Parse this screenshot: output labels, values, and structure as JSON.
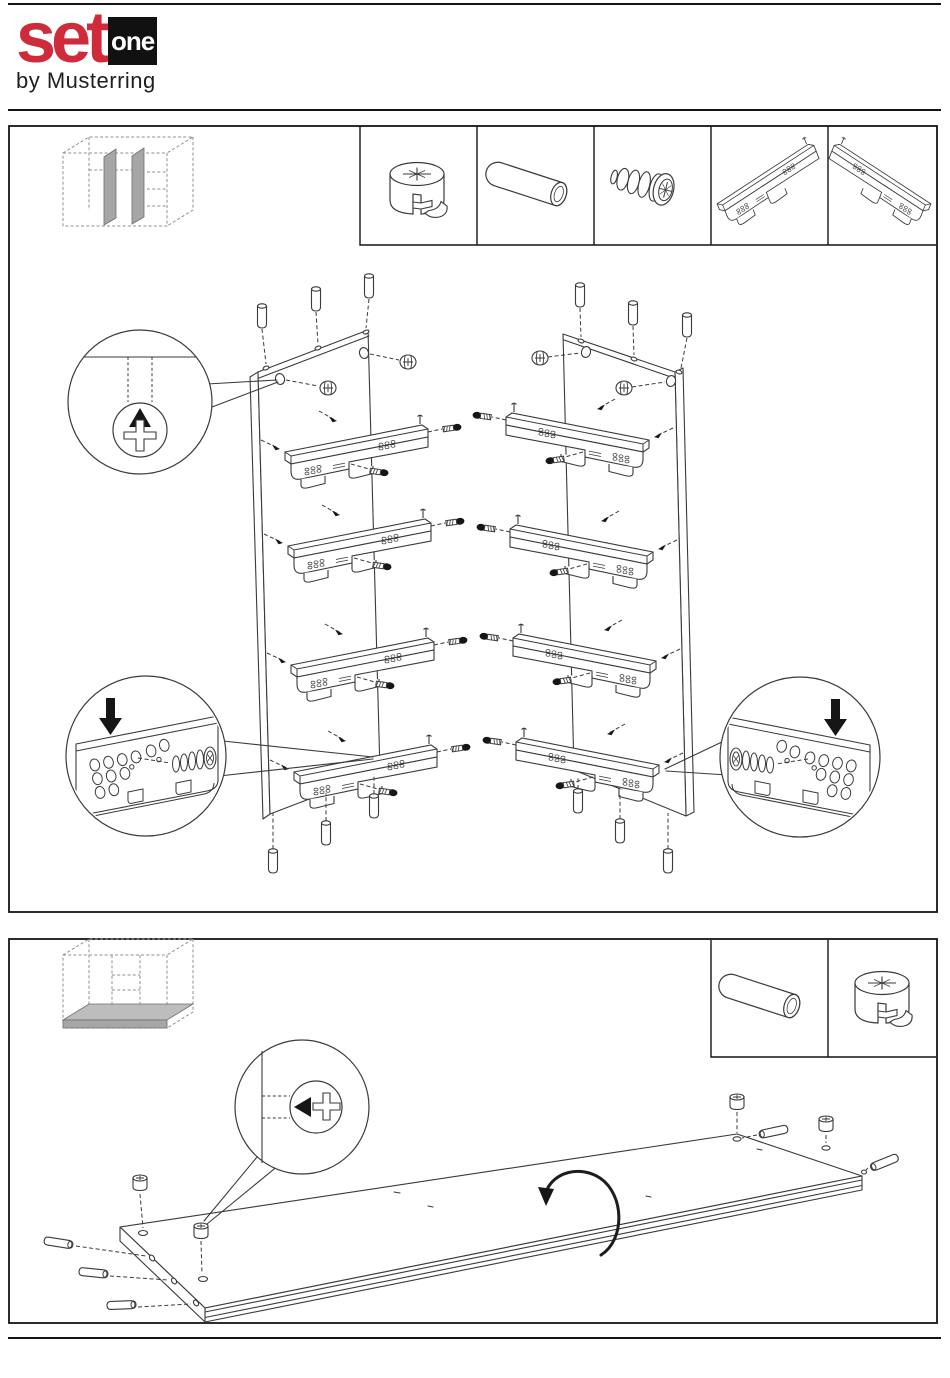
{
  "page": {
    "background": "#ffffff",
    "rule_color": "#141414"
  },
  "header": {
    "logo_word": "set",
    "logo_badge": "one",
    "logo_byline": "by Musterring",
    "brand_red": "#cf2b3b",
    "badge_bg": "#111111"
  },
  "steps": [
    {
      "hardware_icons": [
        "cam-lock-icon",
        "wooden-dowel-icon",
        "euro-screw-icon",
        "drawer-slide-left-icon",
        "drawer-slide-right-icon"
      ],
      "thumbnail": "cabinet-two-partitions-highlighted",
      "illustration": "two-partition-panels-with-four-drawer-slides-dowels-and-cam-studs",
      "callouts": [
        "cam-stud-detail-arrow-up",
        "slide-screw-detail-left",
        "slide-screw-detail-right"
      ]
    },
    {
      "hardware_icons": [
        "wooden-dowel-icon",
        "cam-lock-icon"
      ],
      "thumbnail": "cabinet-bottom-panel-highlighted",
      "illustration": "bottom-panel-with-dowels-and-cam-studs",
      "callouts": [
        "cam-stud-detail-arrow-left",
        "rotate-panel-arrow"
      ]
    }
  ],
  "art": {
    "line_color": "#3a3a3a",
    "gray_fill": "#a6a6a6",
    "black": "#161616"
  }
}
